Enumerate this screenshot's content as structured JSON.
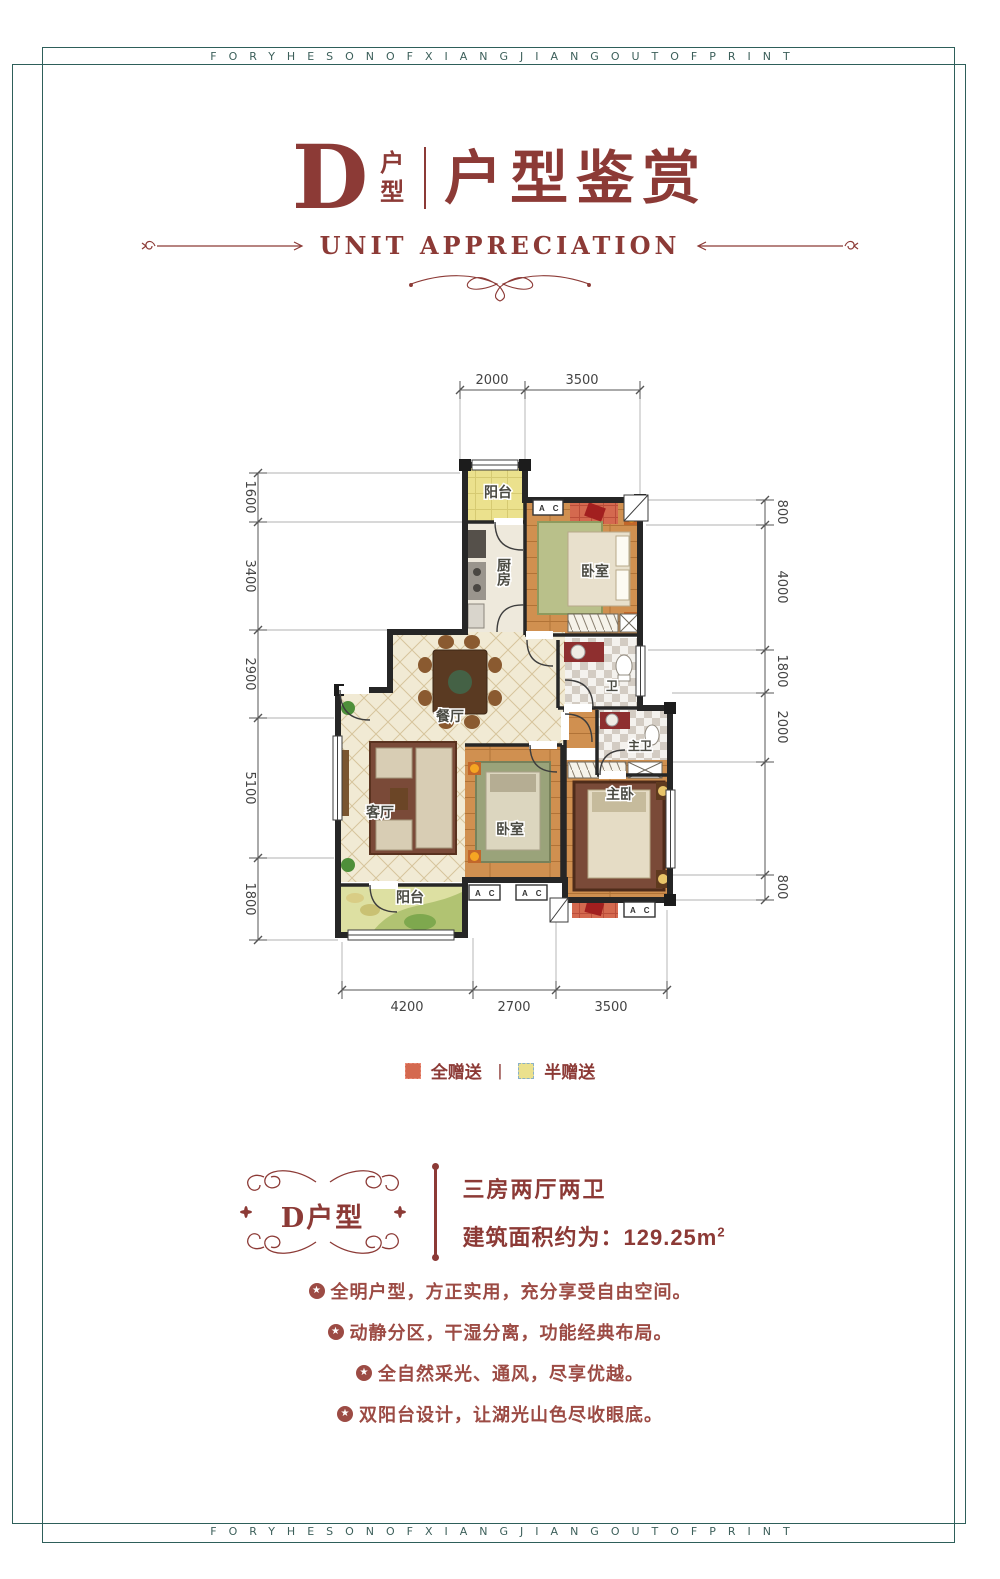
{
  "colors": {
    "accent": "#8c3a36",
    "accent-light": "#9c4b44",
    "frame": "#2e5f5a",
    "band-text": "#3c5f5a",
    "wall": "#262626",
    "dim": "#444444",
    "wood": "#d09050",
    "tile-cream": "#f1ead4",
    "half-gift": "#ebe18d",
    "full-gift": "#d4694f",
    "label": "#4a4a42"
  },
  "band": {
    "top_text": "FORYHESONOFXIANGJIANGOUTOFPRINT",
    "bottom_text": "FORYHESONOFXIANGJIANGOUTOFPRINT"
  },
  "header": {
    "letter": "D",
    "letter_caption": "户型",
    "title": "户型鉴赏",
    "subtitle": "UNIT APPRECIATION"
  },
  "plan": {
    "dims": {
      "top": [
        "2000",
        "3500"
      ],
      "left": [
        "1600",
        "3400",
        "2900",
        "5100",
        "1800"
      ],
      "right": [
        "800",
        "4000",
        "1800",
        "2000",
        "800"
      ],
      "bottom": [
        "4200",
        "2700",
        "3500"
      ]
    },
    "rooms": {
      "balcony_top": "阳台",
      "kitchen": "厨房",
      "bedroom_top": "卧室",
      "bath": "卫",
      "dining": "餐厅",
      "living": "客厅",
      "bedroom_mid": "卧室",
      "master_bath": "主卫",
      "master_bedroom": "主卧",
      "balcony_bottom": "阳台"
    },
    "ac_label": "A C"
  },
  "legend": {
    "full": "全赠送",
    "divider": "|",
    "half": "半赠送"
  },
  "summary": {
    "badge": "D户型",
    "layout": "三房两厅两卫",
    "area_label": "建筑面积约为：129.25m",
    "area_sup": "2"
  },
  "features": [
    "全明户型，方正实用，充分享受自由空间。",
    "动静分区，干湿分离，功能经典布局。",
    "全自然采光、通风，尽享优越。",
    "双阳台设计，让湖光山色尽收眼底。"
  ],
  "feature_icon": "★"
}
